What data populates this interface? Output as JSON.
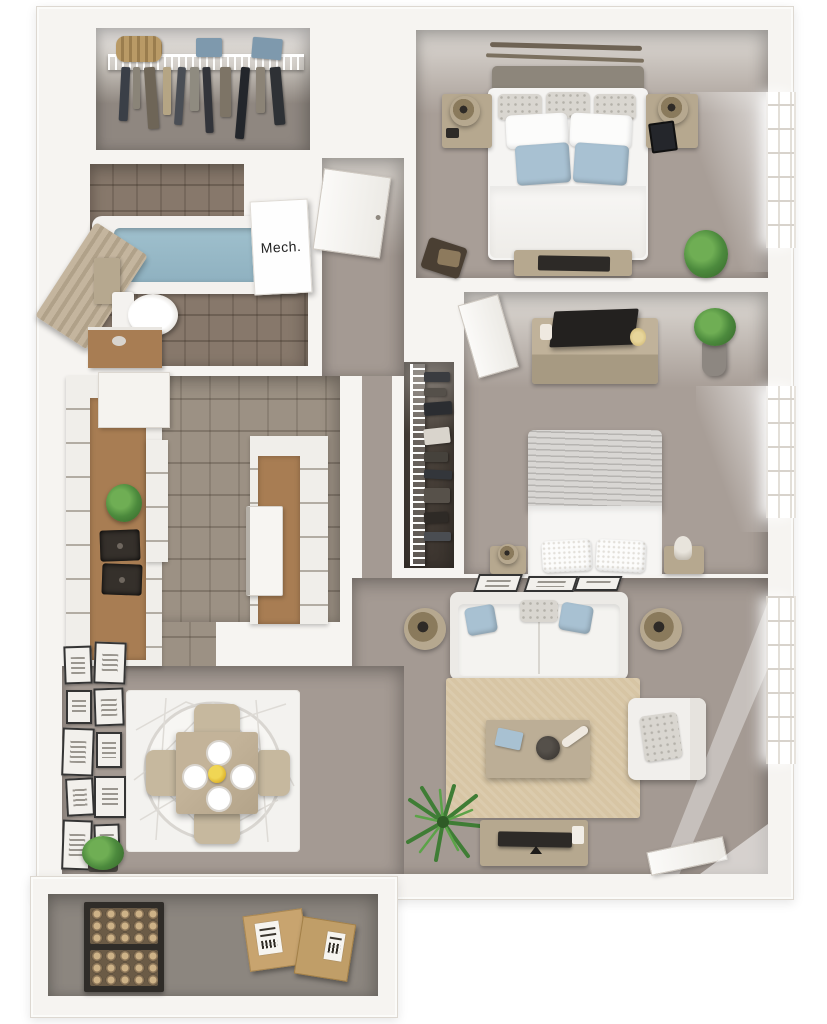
{
  "scene": {
    "type": "3d-floor-plan-top-view",
    "style": "photoreal dollhouse render, one-bedroom-style apartment"
  },
  "rooms": {
    "walk_in_closet": {
      "items": [
        "wire-shelf",
        "duffel-bag",
        "folded-shirts",
        "hanging-garments"
      ]
    },
    "bathroom": {
      "items": [
        "bathtub-with-water",
        "shower-curtain",
        "toilet",
        "wood-vanity",
        "wall-cabinet"
      ]
    },
    "mech_closet": {
      "label": "Mech.",
      "items": [
        "mechanical-unit-box"
      ]
    },
    "entry_hall": {
      "items": [
        "entry-door",
        "carpet"
      ]
    },
    "bedroom_1": {
      "items": [
        "double-bed",
        "grey-pillows",
        "white-pillows",
        "blue-pillows",
        "nightstand-left",
        "nightstand-right",
        "table-lamps",
        "wall-art-rods",
        "foot-bench-with-tv",
        "dark-chair",
        "corner-plant",
        "window"
      ]
    },
    "bedroom_2": {
      "items": [
        "door",
        "dresser-with-tv",
        "potted-plant",
        "double-bed-grey-blanket",
        "nightstand-left",
        "nightstand-right",
        "window"
      ]
    },
    "bedroom_2_closet": {
      "items": [
        "wire-shelf",
        "hanging-garments"
      ]
    },
    "kitchen": {
      "items": [
        "upper-cabinets",
        "wood-countertop-left",
        "double-basin-sink",
        "counter-plant",
        "peninsula-counter",
        "white-range",
        "tile-floor"
      ]
    },
    "living_room": {
      "items": [
        "three-wall-frames",
        "sofa",
        "blue-throw-pillows",
        "table-lamp-left",
        "table-lamp-right",
        "area-rug",
        "coffee-table",
        "decor-blue-box",
        "decor-dark-bowl",
        "armchair",
        "palm-plant",
        "media-console-with-tv",
        "patio-door",
        "window"
      ]
    },
    "dining_area": {
      "items": [
        "gallery-wall-frames",
        "geometric-round-rug",
        "square-dining-table",
        "four-chairs",
        "four-place-settings",
        "yellow-centerpiece",
        "potted-plant"
      ]
    },
    "patio_storage": {
      "items": [
        "firewood-rack",
        "cardboard-boxes"
      ]
    }
  },
  "colors": {
    "bg": "#ffffff",
    "wall": "#f6f4f1",
    "wall-edge": "#ddd8d1",
    "carpet": "#a49a93",
    "bedcarpet": "#a89e97",
    "tile": "#9c9184",
    "bathtile": "#87786b",
    "closet1-floor": "#8f8780",
    "closet2-dark": "#4a423b",
    "patio": "#8c867f",
    "wood": "#a87d53",
    "tan": "#b6a88f",
    "tan-light": "#c6b89e",
    "rug": "#d7c5a4",
    "rug-white": "#f3f2ef",
    "blue": "#a8c1d2",
    "tub": "#8fb1c0",
    "curtain": "#c4b59e",
    "green": "#4c8a3d",
    "green-dark": "#336328",
    "cardboard": "#c8a46f",
    "dark": "#2d2a27",
    "frame": "#343434",
    "blanket": "#d8d6d3",
    "headboard": "#8d867b"
  }
}
